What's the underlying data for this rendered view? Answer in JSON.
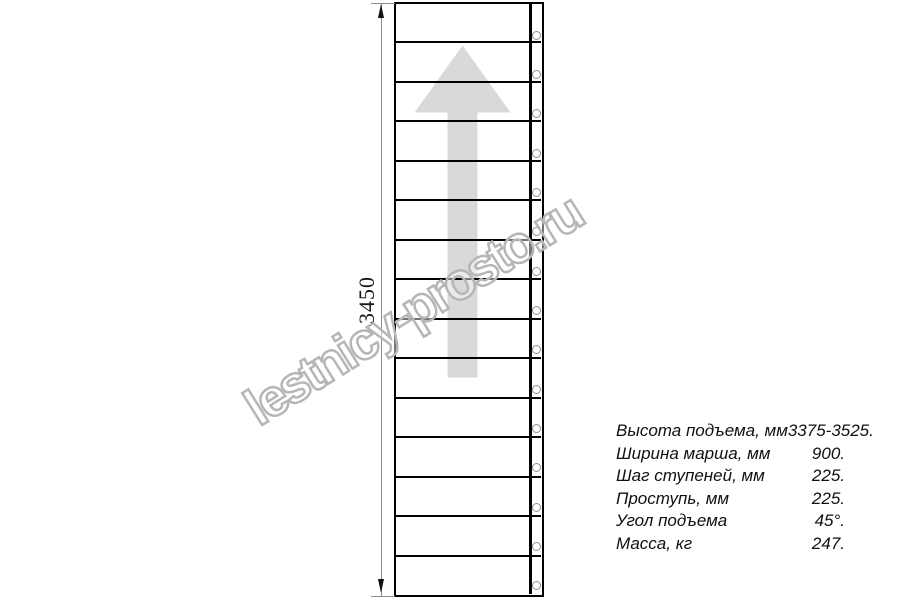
{
  "watermark": {
    "text": "lestnicy-prosto.ru"
  },
  "dimension": {
    "value": "3450"
  },
  "drawing": {
    "type": "straight-staircase-top-view",
    "treads": 15,
    "arrow_direction": "up",
    "arrow_color": "#d9d9d9",
    "line_color": "#000000",
    "fastener_count": 15
  },
  "specs": {
    "rows": [
      {
        "label": "Высота подъема, мм",
        "value": "3375-3525."
      },
      {
        "label": "Ширина марша, мм",
        "value": "900."
      },
      {
        "label": "Шаг ступеней, мм",
        "value": "225."
      },
      {
        "label": "Проступь, мм",
        "value": "225."
      },
      {
        "label": "Угол подъема",
        "value": "45°."
      },
      {
        "label": "Масса, кг",
        "value": "247."
      }
    ]
  }
}
